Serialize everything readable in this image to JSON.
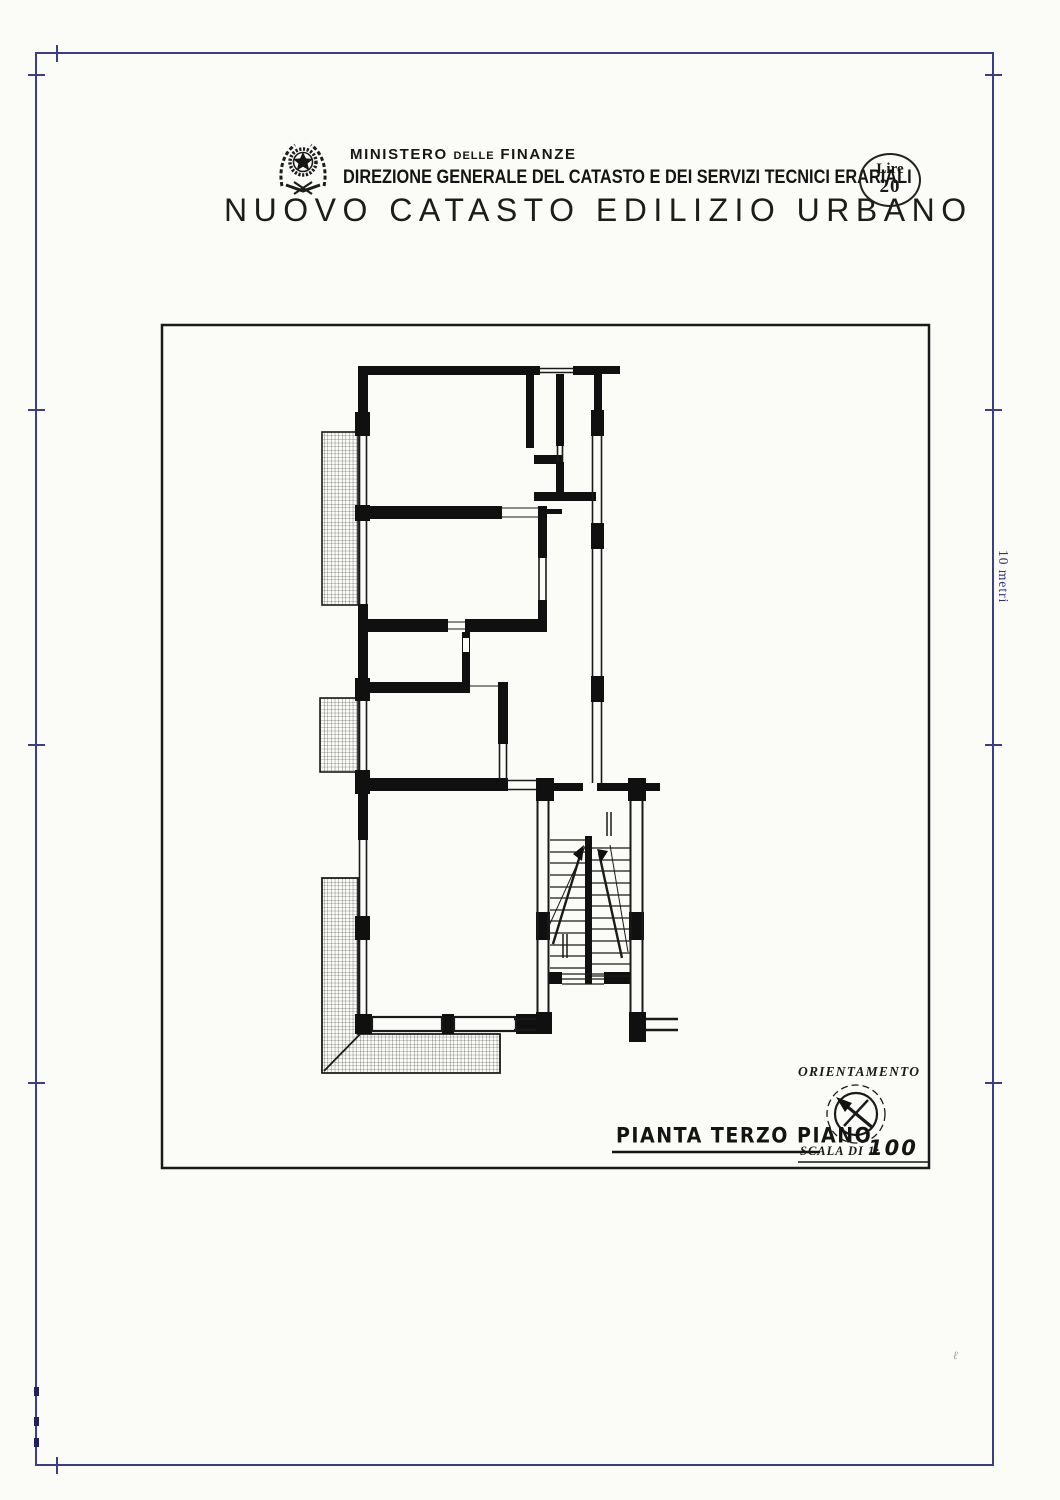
{
  "colors": {
    "paper": "#fbfbf8",
    "ink": "#141414",
    "margin_line": "#3e3e86",
    "side_note": "#32327a"
  },
  "header": {
    "ministry_word1": "MINISTERO",
    "ministry_word2": "DELLE",
    "ministry_word3": "FINANZE",
    "direction_line": "DIREZIONE GENERALE DEL CATASTO E DEI SERVIZI TECNICI ERARIALI",
    "main_title": "NUOVO CATASTO EDILIZIO URBANO",
    "stamp": {
      "line1": "Lire",
      "line2": "20"
    },
    "emblem_icon": "italian-state-emblem"
  },
  "margin": {
    "side_note": "10 metri"
  },
  "plan": {
    "orientation_label": "ORIENTAMENTO",
    "compass_icon": "north-arrow",
    "title": "PIANTA TERZO PIANO",
    "scale_label": "SCALA DI 1:",
    "scale_value": "100"
  },
  "artifacts": {
    "stray_mark": "ℓ"
  }
}
